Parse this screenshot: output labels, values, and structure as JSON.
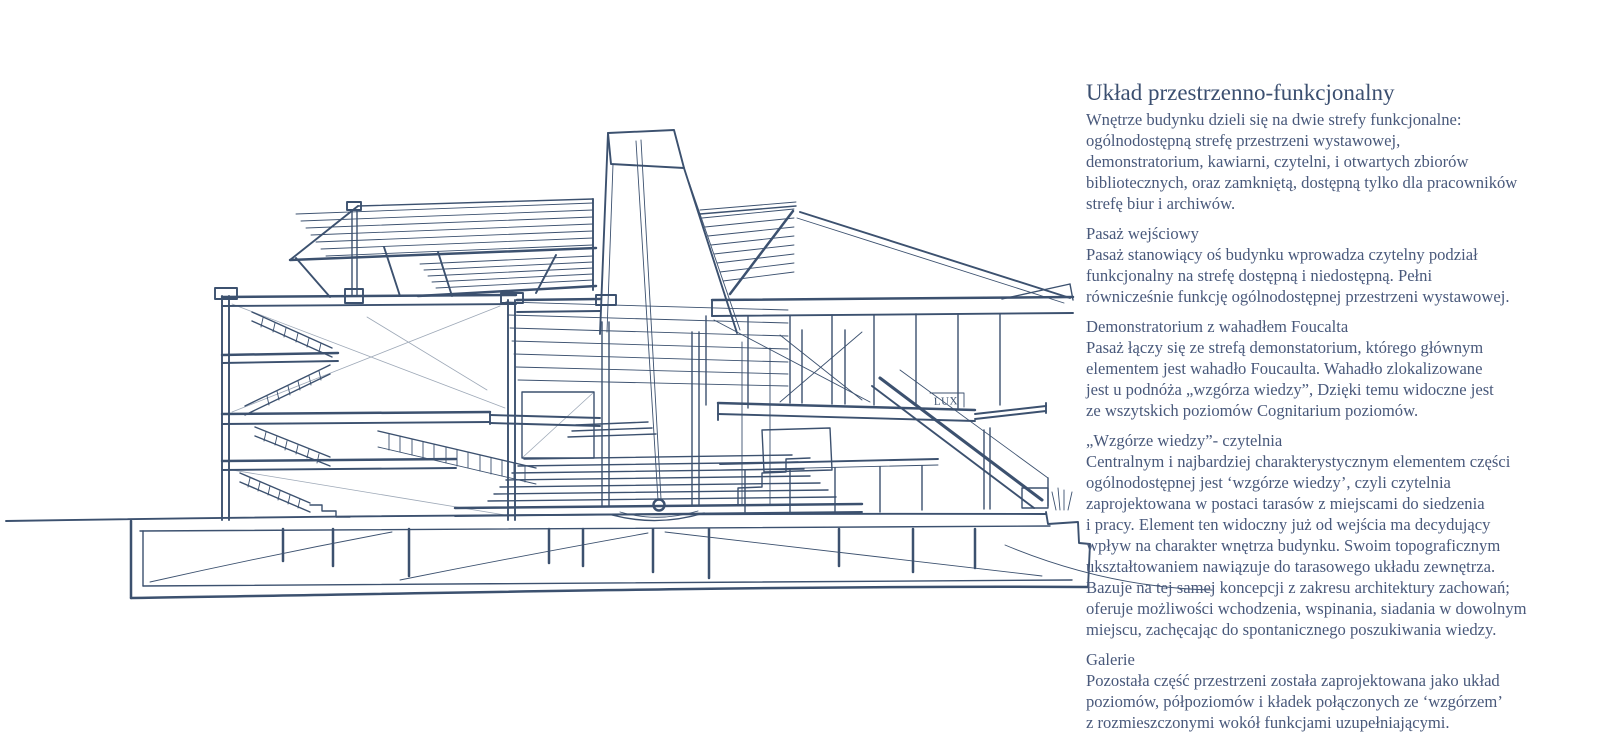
{
  "page": {
    "background": "#ffffff",
    "ink_color": "#3c516f",
    "text_color": "#49597b"
  },
  "sketch": {
    "lux_label": "LUX"
  },
  "article": {
    "title": "Układ przestrzenno-funkcjonalny",
    "sections": [
      {
        "heading": "",
        "body": "Wnętrze budynku dzieli się na dwie strefy funkcjonalne:\nogólnodostępną strefę przestrzeni wystawowej,\ndemonstratorium, kawiarni, czytelni, i otwartych zbiorów\nbibliotecznych, oraz zamkniętą, dostępną tylko dla pracowników\nstrefę biur i archiwów."
      },
      {
        "heading": "Pasaż wejściowy",
        "body": "Pasaż stanowiący oś budynku wprowadza czytelny podział\nfunkcjonalny na strefę dostępną i niedostępną. Pełni\nrównicześnie funkcję ogólnodostępnej przestrzeni wystawowej."
      },
      {
        "heading": "Demonstratorium z wahadłem Foucalta",
        "body": "Pasaż łączy się ze strefą demonstatorium, którego głównym\nelementem jest wahadło Foucaulta. Wahadło zlokalizowane\njest u podnóża „wzgórza wiedzy”, Dzięki temu widoczne jest\nze wszytskich poziomów Cognitarium poziomów."
      },
      {
        "heading": "„Wzgórze wiedzy”- czytelnia",
        "body": "Centralnym i najbardziej charakterystycznym elementem części\nogólnodostępnej jest ‘wzgórze wiedzy’, czyli czytelnia\nzaprojektowana w postaci tarasów z miejscami do siedzenia\ni pracy. Element ten widoczny już od wejścia ma decydujący\nwpływ na charakter wnętrza budynku. Swoim topograficznym\nukształtowaniem nawiązuje do tarasowego układu zewnętrza.\nBazuje na tej samej koncepcji z zakresu architektury zachowań;\noferuje możliwości wchodzenia, wspinania, siadania w dowolnym\nmiejscu, zachęcając do spontanicznego poszukiwania wiedzy."
      },
      {
        "heading": "Galerie",
        "body": "Pozostała część przestrzeni została zaprojektowana jako układ\npoziomów, półpoziomów i kładek połączonych ze ‘wzgórzem’\nz rozmieszczonymi wokół funkcjami uzupełniającymi."
      }
    ]
  }
}
